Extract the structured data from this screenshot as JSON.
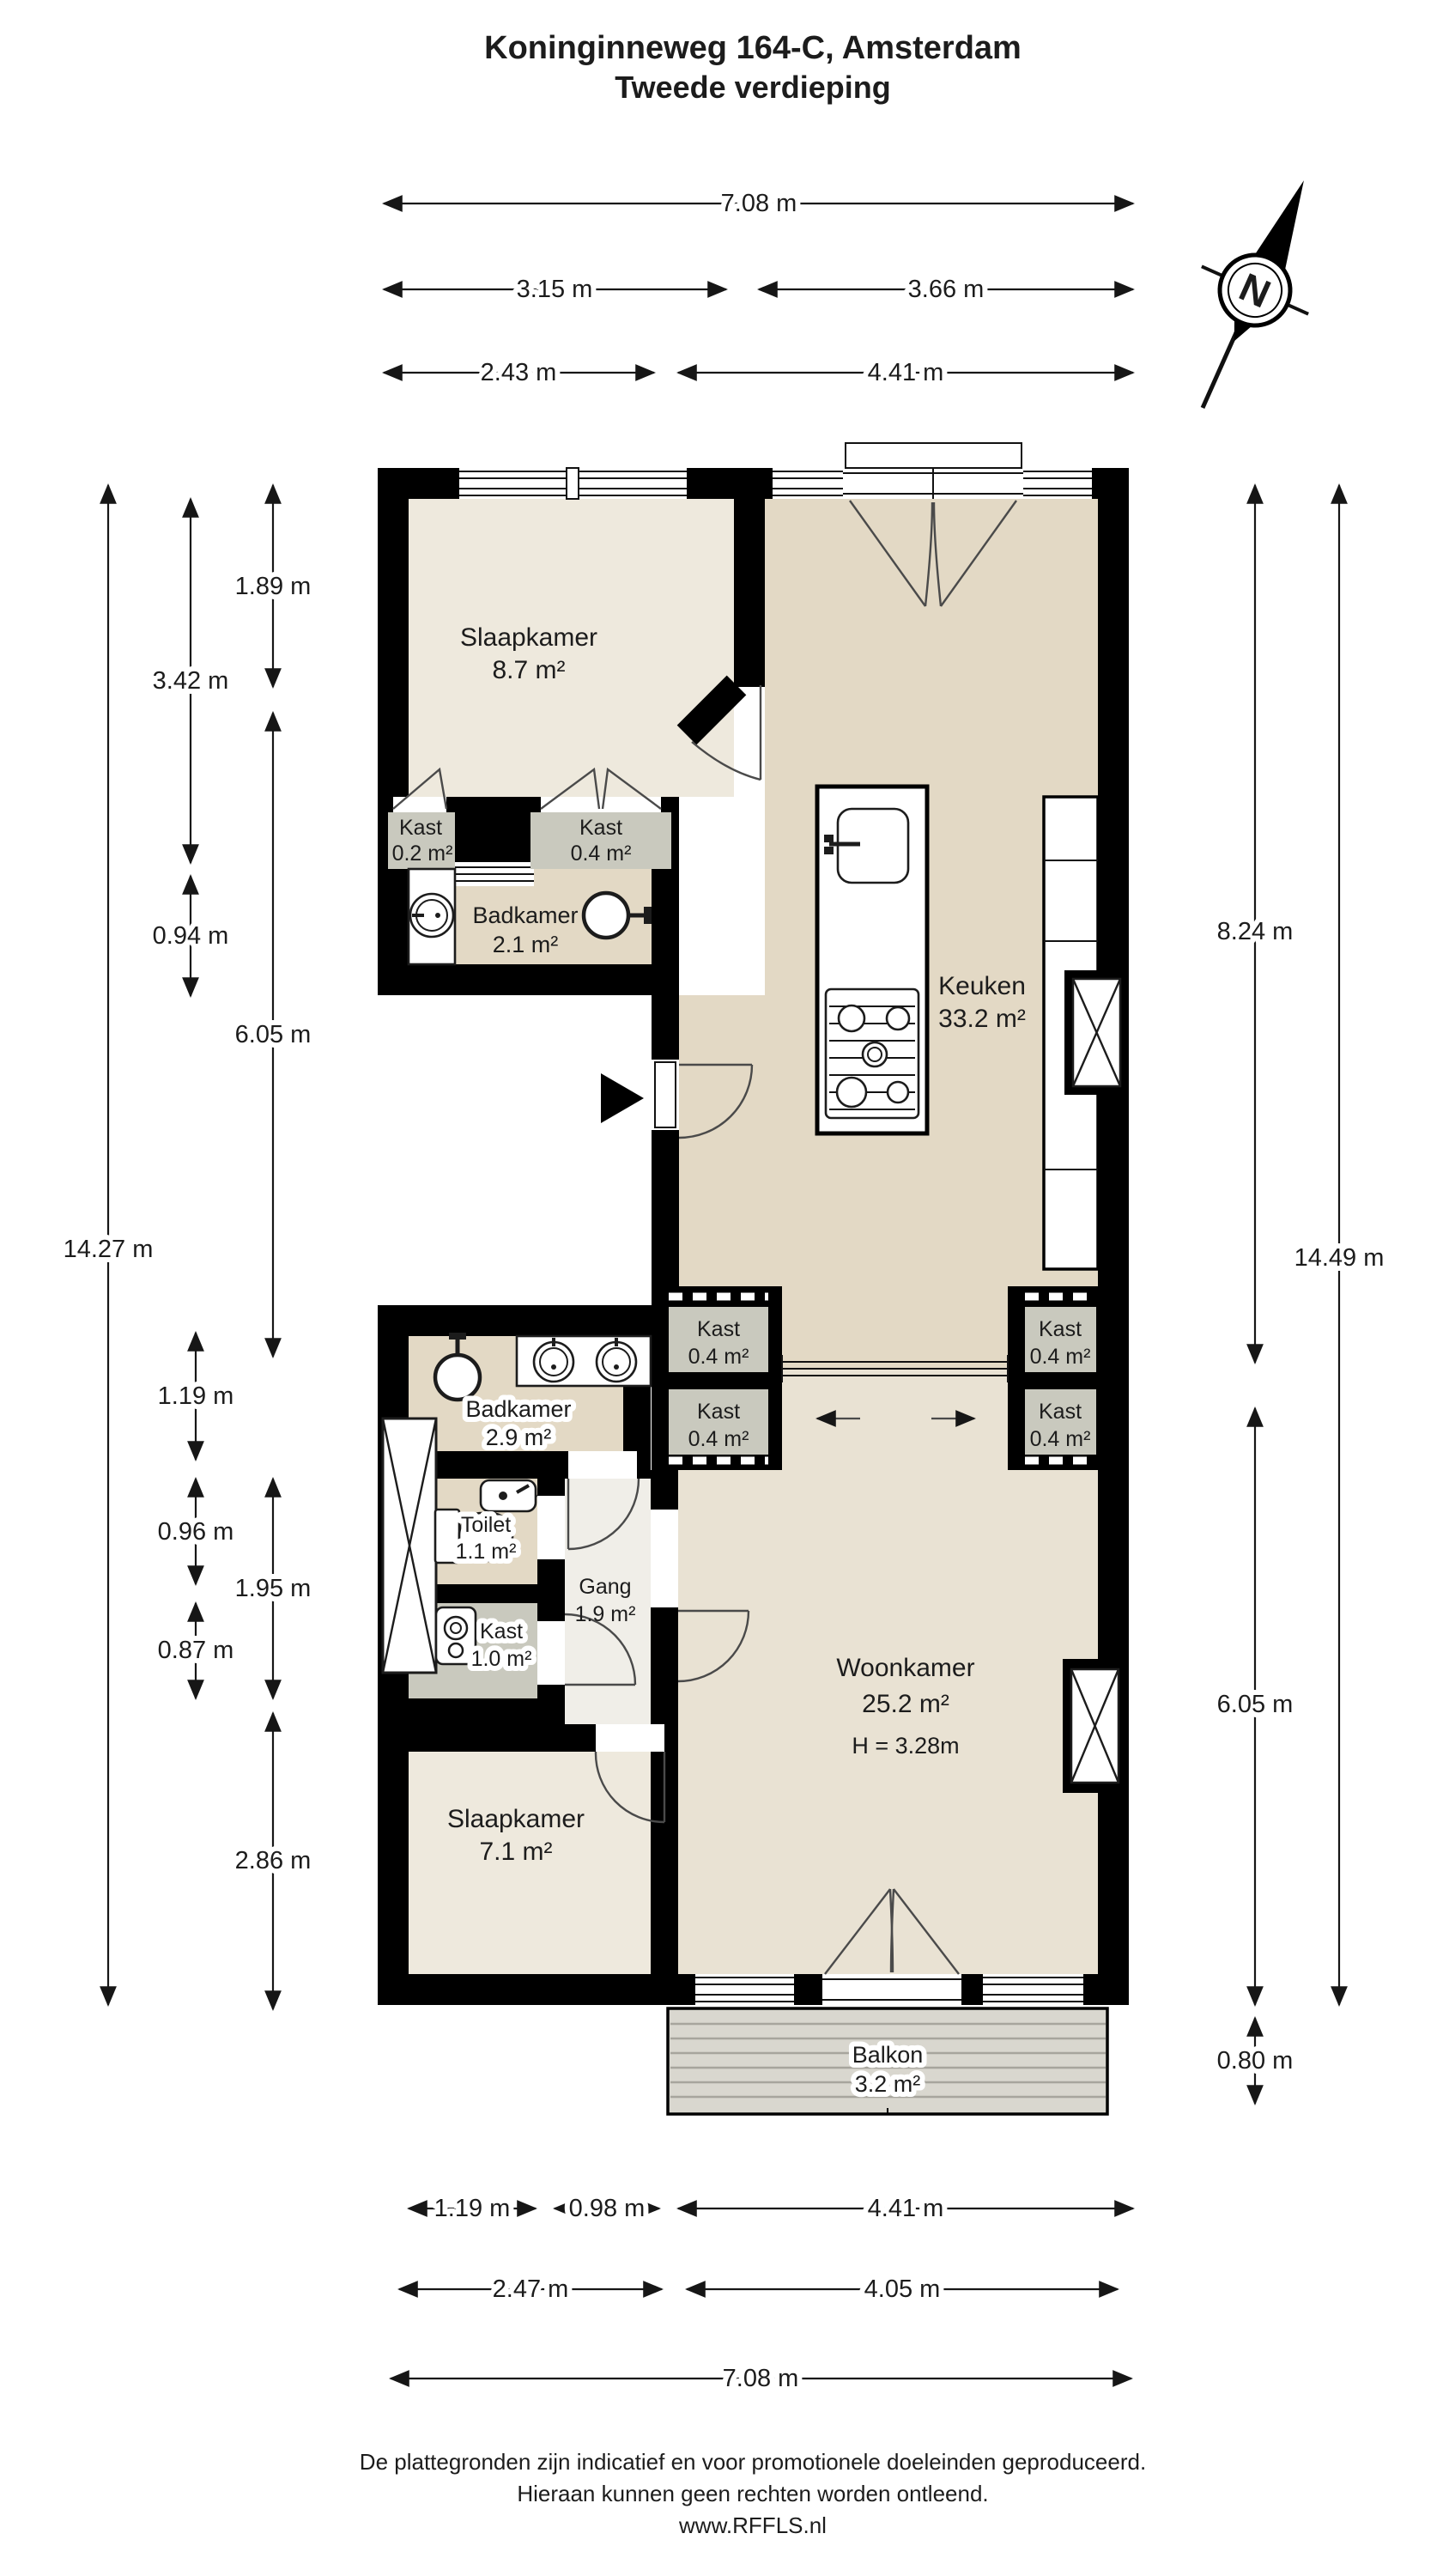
{
  "title": {
    "line1": "Koninginneweg 164-C, Amsterdam",
    "line2": "Tweede verdieping"
  },
  "compass": {
    "label": "N"
  },
  "rooms": {
    "slaapkamer1": {
      "name": "Slaapkamer",
      "area": "8.7 m²"
    },
    "kast02": {
      "name": "Kast",
      "area": "0.2 m²"
    },
    "kast04a": {
      "name": "Kast",
      "area": "0.4 m²"
    },
    "badkamer1": {
      "name": "Badkamer",
      "area": "2.1 m²"
    },
    "keuken": {
      "name": "Keuken",
      "area": "33.2 m²"
    },
    "kast04b": {
      "name": "Kast",
      "area": "0.4 m²"
    },
    "kast04c": {
      "name": "Kast",
      "area": "0.4 m²"
    },
    "kast04d": {
      "name": "Kast",
      "area": "0.4 m²"
    },
    "kast04e": {
      "name": "Kast",
      "area": "0.4 m²"
    },
    "badkamer2": {
      "name": "Badkamer",
      "area": "2.9 m²"
    },
    "toilet": {
      "name": "Toilet",
      "area": "1.1 m²"
    },
    "gang": {
      "name": "Gang",
      "area": "1.9 m²"
    },
    "kast10": {
      "name": "Kast",
      "area": "1.0 m²"
    },
    "woonkamer": {
      "name": "Woonkamer",
      "area": "25.2 m²",
      "ceiling": "H = 3.28m"
    },
    "slaapkamer2": {
      "name": "Slaapkamer",
      "area": "7.1 m²"
    },
    "balkon": {
      "name": "Balkon",
      "area": "3.2 m²"
    }
  },
  "dims_top": [
    "7.08 m",
    "3.15 m",
    "3.66 m",
    "2.43 m",
    "4.41 m"
  ],
  "dims_left": [
    "14.27 m",
    "3.42 m",
    "0.94 m",
    "1.89 m",
    "6.05 m",
    "1.19 m",
    "0.96 m",
    "0.87 m",
    "1.95 m",
    "2.86 m"
  ],
  "dims_right": [
    "8.24 m",
    "14.49 m",
    "6.05 m",
    "0.80 m"
  ],
  "dims_bottom": [
    "1.19 m",
    "0.98 m",
    "4.41 m",
    "2.47 m",
    "4.05 m",
    "7.08 m"
  ],
  "footer": {
    "line1": "De plattegronden zijn indicatief en voor promotionele doeleinden geproduceerd.",
    "line2": "Hieraan kunnen geen rechten worden ontleend.",
    "line3": "www.RFFLS.nl"
  },
  "colors": {
    "wall": "#000000",
    "room_light": "#eee9dd",
    "room_tan": "#e3d9c5",
    "woonkamer": "#e9e2d3",
    "kast_gray": "#c9c9be",
    "gang": "#f0eee8",
    "balkon_deck": "#d9d7cf"
  }
}
